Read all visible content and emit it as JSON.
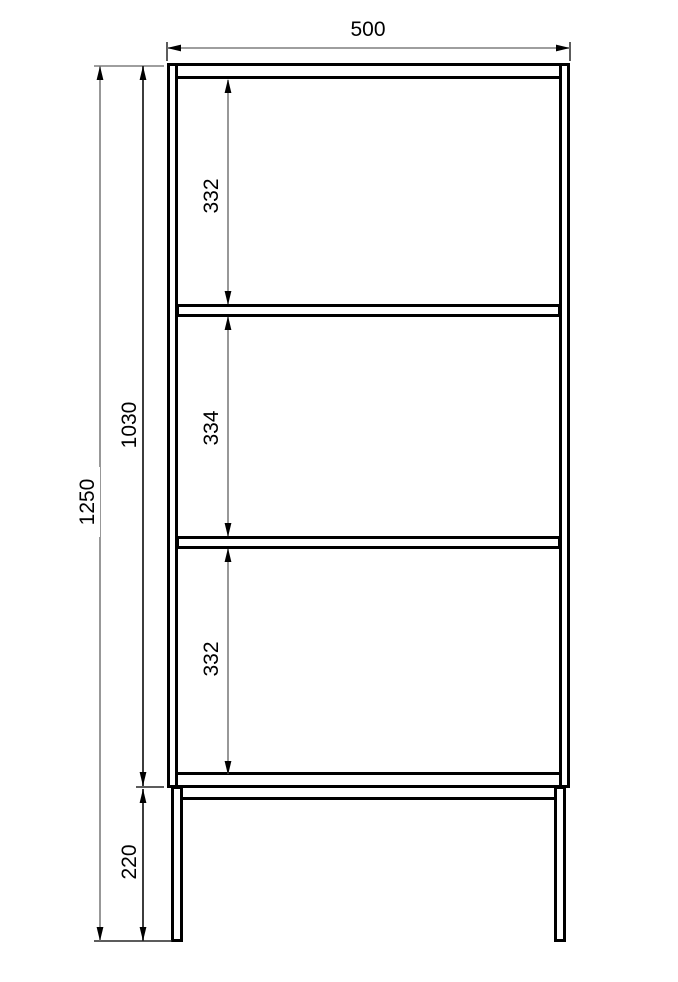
{
  "drawing": {
    "labels": {
      "overall_width": "500",
      "overall_height": "1250",
      "body_height": "1030",
      "leg_height": "220",
      "compartment_top": "332",
      "compartment_middle": "334",
      "compartment_bottom": "332"
    },
    "colors": {
      "outline": "#000000",
      "dimension_line_gray": "#7f7f7f",
      "dimension_line_dark": "#262626",
      "arrow": "#000000",
      "label_text": "#000000",
      "background": "#ffffff"
    }
  }
}
